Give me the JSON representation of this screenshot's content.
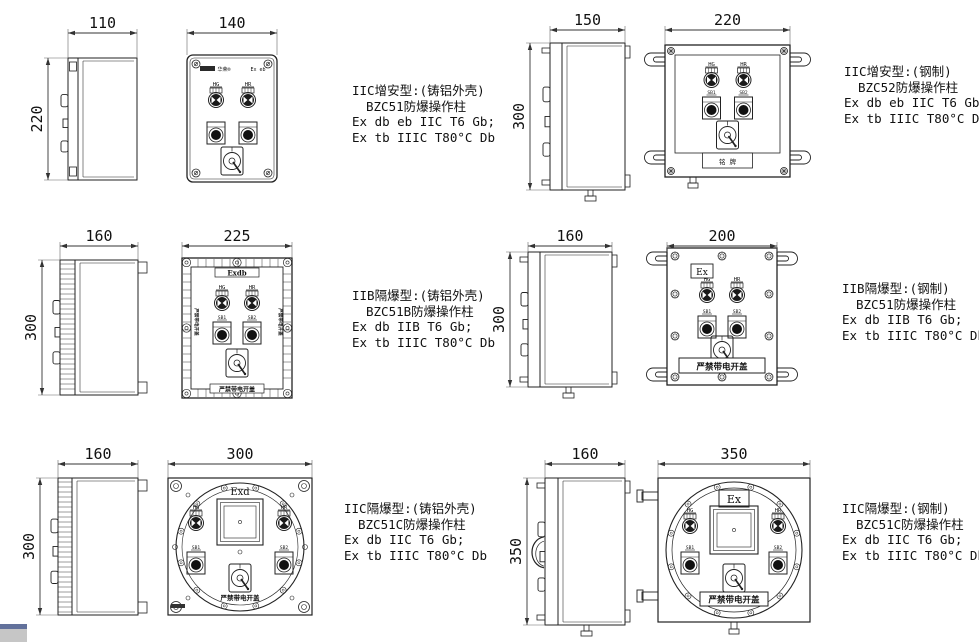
{
  "colors": {
    "background": "#ffffff",
    "line": "#222222",
    "dim_line": "#333333",
    "artifact_gray": "#c6c6c6",
    "artifact_blue": "#62719b"
  },
  "products": [
    {
      "model": "BZC51",
      "description": [
        "IIC增安型:(铸铝外壳)",
        "BZC51防爆操作柱",
        "Ex db eb IIC T6 Gb;",
        "Ex tb IIIC T80°C Db"
      ],
      "dimensions": {
        "side_width": "110",
        "height": "220",
        "front_width": "140"
      },
      "panel": {
        "brand": "华荣®",
        "marking": "Ex eb",
        "lamp_left": "HG",
        "lamp_right": "HR"
      }
    },
    {
      "model": "BZC52",
      "description": [
        "IIC增安型:(钢制)",
        "BZC52防爆操作柱",
        "Ex db eb IIC T6 Gb;",
        "Ex tb IIIC T80°C Db"
      ],
      "dimensions": {
        "side_width": "150",
        "height": "300",
        "front_width": "220"
      },
      "panel": {
        "lamp_left": "HG",
        "lamp_right": "HR",
        "button_left": "SB1",
        "button_right": "SB2",
        "nameplate": "铭 牌"
      }
    },
    {
      "model": "BZC51B",
      "description": [
        "IIB隔爆型:(铸铝外壳)",
        "BZC51B防爆操作柱",
        "Ex db IIB T6 Gb;",
        "Ex tb IIIC T80°C Db"
      ],
      "dimensions": {
        "side_width": "160",
        "height": "300",
        "front_width": "225"
      },
      "panel": {
        "marking": "Exdb",
        "lamp_left": "HG",
        "lamp_right": "HR",
        "button_left": "SB1",
        "button_right": "SB2",
        "warning": "严禁带电开盖"
      }
    },
    {
      "model": "BZC51",
      "description": [
        "IIB隔爆型:(钢制)",
        "BZC51防爆操作柱",
        "Ex db IIB T6 Gb;",
        "Ex tb IIIC T80°C Db"
      ],
      "dimensions": {
        "side_width": "160",
        "height": "300",
        "front_width": "200"
      },
      "panel": {
        "marking": "Ex",
        "lamp_left": "HG",
        "lamp_right": "HR",
        "button_left": "SB1",
        "button_right": "SB2",
        "warning": "严禁带电开盖"
      }
    },
    {
      "model": "BZC51C",
      "description": [
        "IIC隔爆型:(铸铝外壳)",
        "BZC51C防爆操作柱",
        "Ex db IIC T6 Gb;",
        "Ex tb IIIC T80°C Db"
      ],
      "dimensions": {
        "side_width": "160",
        "height": "300",
        "front_width": "300"
      },
      "panel": {
        "marking": "Exd",
        "lamp_left": "HG",
        "lamp_right": "HR",
        "button_left": "SB1",
        "button_right": "SB2",
        "warning": "严禁带电开盖"
      }
    },
    {
      "model": "BZC51C",
      "description": [
        "IIC隔爆型:(钢制)",
        "BZC51C防爆操作柱",
        "Ex db IIC T6 Gb;",
        "Ex tb IIIC T80°C Db"
      ],
      "dimensions": {
        "side_width": "160",
        "height": "350",
        "front_width": "350"
      },
      "panel": {
        "marking": "Ex",
        "lamp_left": "HG",
        "lamp_right": "HR",
        "button_left": "SB1",
        "button_right": "SB2",
        "warning": "严禁带电开盖"
      }
    }
  ]
}
